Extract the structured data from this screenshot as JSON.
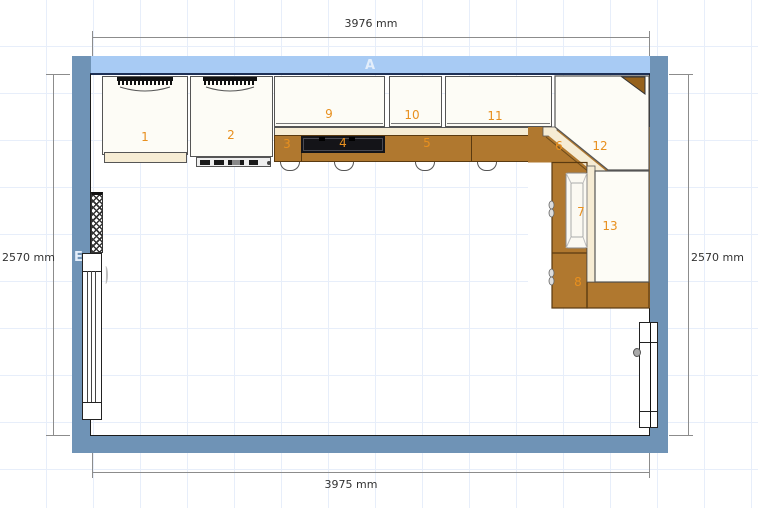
{
  "plan": {
    "wall_top_label": "A",
    "wall_left_label": "E",
    "dim_top": "3976 mm",
    "dim_bottom": "3975 mm",
    "dim_left": "2570 mm",
    "dim_right": "2570 mm"
  },
  "units": [
    {
      "label": "1",
      "kind": "tall-appliance-unit"
    },
    {
      "label": "2",
      "kind": "tall-appliance-unit-oven"
    },
    {
      "label": "3",
      "kind": "base-counter-section"
    },
    {
      "label": "4",
      "kind": "cooktop"
    },
    {
      "label": "5",
      "kind": "base-counter-section"
    },
    {
      "label": "6",
      "kind": "corner-base-counter"
    },
    {
      "label": "7",
      "kind": "sink"
    },
    {
      "label": "8",
      "kind": "base-counter-section"
    },
    {
      "label": "9",
      "kind": "wall-cabinet"
    },
    {
      "label": "10",
      "kind": "wall-cabinet"
    },
    {
      "label": "11",
      "kind": "wall-cabinet"
    },
    {
      "label": "12",
      "kind": "corner-wall-cabinet"
    },
    {
      "label": "13",
      "kind": "cabinet"
    }
  ],
  "colors": {
    "wall_top": "#a8cbf4",
    "wall_side": "#6f93b6",
    "counter": "#b0782f",
    "counter_edge": "#5a3a10",
    "cabinet_fill": "#fdfcf6",
    "cream_trim": "#f6ecd4",
    "cooktop": "#141418",
    "unit_label": "#e8901f",
    "grid_line": "#e7eefa",
    "dim_line": "#8c8c8c"
  }
}
